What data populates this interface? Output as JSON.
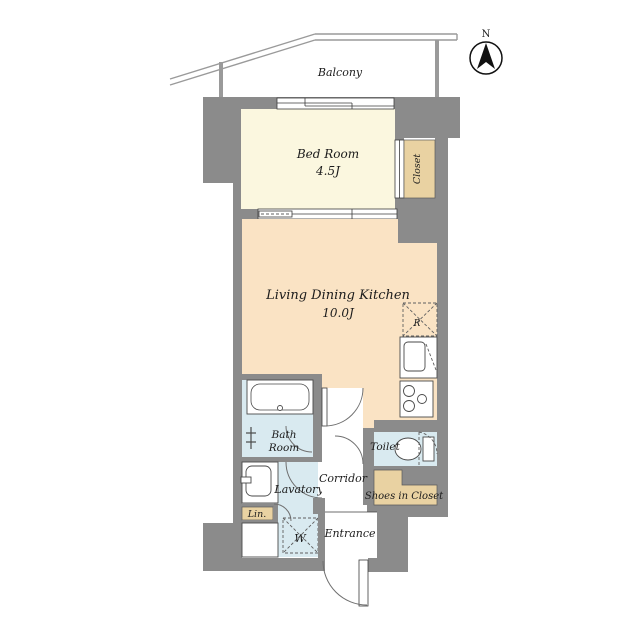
{
  "title": "1K apartment floor plan",
  "colors": {
    "wall": "#8b8b8b",
    "bedroom": "#fbf7df",
    "ldk": "#fae3c4",
    "closet": "#e9d2a2",
    "wet": "#d9eaf0",
    "railing": "#9a9a9a"
  },
  "compass": {
    "north_label": "N"
  },
  "balcony": {
    "label": "Balcony"
  },
  "rooms": {
    "bedroom": {
      "name": "Bed Room",
      "size": "4.5J"
    },
    "ldk": {
      "name": "Living Dining Kitchen",
      "size": "10.0J"
    },
    "closet": {
      "label": "Closet"
    },
    "bath": {
      "line1": "Bath",
      "line2": "Room"
    },
    "lavatory": {
      "label": "Lavatory"
    },
    "corridor": {
      "label": "Corridor"
    },
    "toilet": {
      "label": "Toilet"
    },
    "shoes_closet": {
      "label": "Shoes in Closet"
    },
    "linen": {
      "label": "Lin."
    },
    "washer": {
      "label": "W"
    },
    "entrance": {
      "label": "Entrance"
    },
    "kitchen": {
      "fridge_label": "R"
    }
  }
}
